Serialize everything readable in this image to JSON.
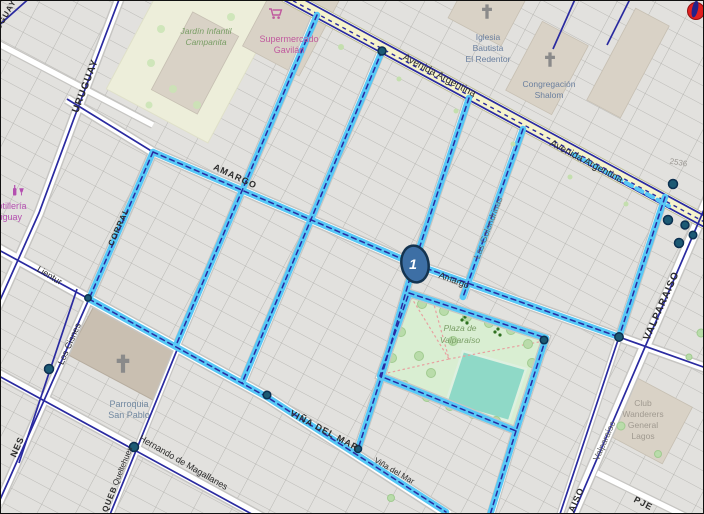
{
  "colors": {
    "background": "#e9e8e5",
    "block": "#e2e1de",
    "parcel_line": "#aeada9",
    "road_fill": "#ffffff",
    "road_casing": "#c6c5c2",
    "main_road": "#f5f3cc",
    "main_road_casing": "#bdbd95",
    "network": "#2a2aa0",
    "route": "#57c8f6",
    "node_fill": "#1c5a74",
    "node_stroke": "#0c3050",
    "marker_fill": "#3d6fa5",
    "marker_stroke": "#14334f",
    "end_marker": "#e02020",
    "park": "#d9eed2",
    "pool": "#8fd9c7",
    "building": "#d9d2c6",
    "church_building": "#c9bfb1",
    "poi_pink": "#c05a9e",
    "poi_purple": "#b44fb0",
    "poi_green": "#7a9e66",
    "poi_blue": "#6a7f9e",
    "label_dark": "#2c2c2c",
    "label_gray": "#a09a90"
  },
  "marker": {
    "label": "1"
  },
  "streets": {
    "uruguay": "URUGUAY",
    "uruguay_fragment": "UGUAY",
    "amargo_major": "AMARGO",
    "amargo_minor": "Amargo",
    "avenida_argentina_a": "Avenida Argentina",
    "avenida_argentina_b": "Avenida Argentina",
    "vina_del_mar_major": "VIÑA DEL MAR",
    "vina_del_mar_minor": "Viña del Mar",
    "hernando_de_magallanes": "Hernando de Magallanes",
    "lientur": "Lientur",
    "los_cisnes": "Los Cisnes",
    "corral": "CORRAL",
    "los_cisnes_fragment": "NES",
    "queltehues": "Queltehues",
    "queltehues_fragment": "QUEB",
    "valparaiso_major": "VALPARAISO",
    "valparaiso_minor": "Valparaíso",
    "valparaiso_fragment": "AISO",
    "pasaje_fragment": "PJE",
    "las_golondrinas": "Las Golondrinas"
  },
  "house_numbers": {
    "n2536": "2536"
  },
  "pois": {
    "jardin": {
      "lines": [
        "Jardín Infantil",
        "Campanita"
      ]
    },
    "supermercado": {
      "lines": [
        "Supermercado",
        "Gavilán"
      ]
    },
    "botilleria": {
      "lines": [
        "Botillería",
        "Uruguay"
      ]
    },
    "iglesia": {
      "lines": [
        "Iglesia",
        "Bautista",
        "El Redentor"
      ]
    },
    "congregacion": {
      "lines": [
        "Congregación",
        "Shalom"
      ]
    },
    "parroquia": {
      "lines": [
        "Parroquia",
        "San Pablo"
      ]
    },
    "plaza": {
      "lines": [
        "Plaza de",
        "Valparaíso"
      ]
    },
    "wanderers": {
      "lines": [
        "Club",
        "Wanderers",
        "General",
        "Lagos"
      ]
    }
  }
}
